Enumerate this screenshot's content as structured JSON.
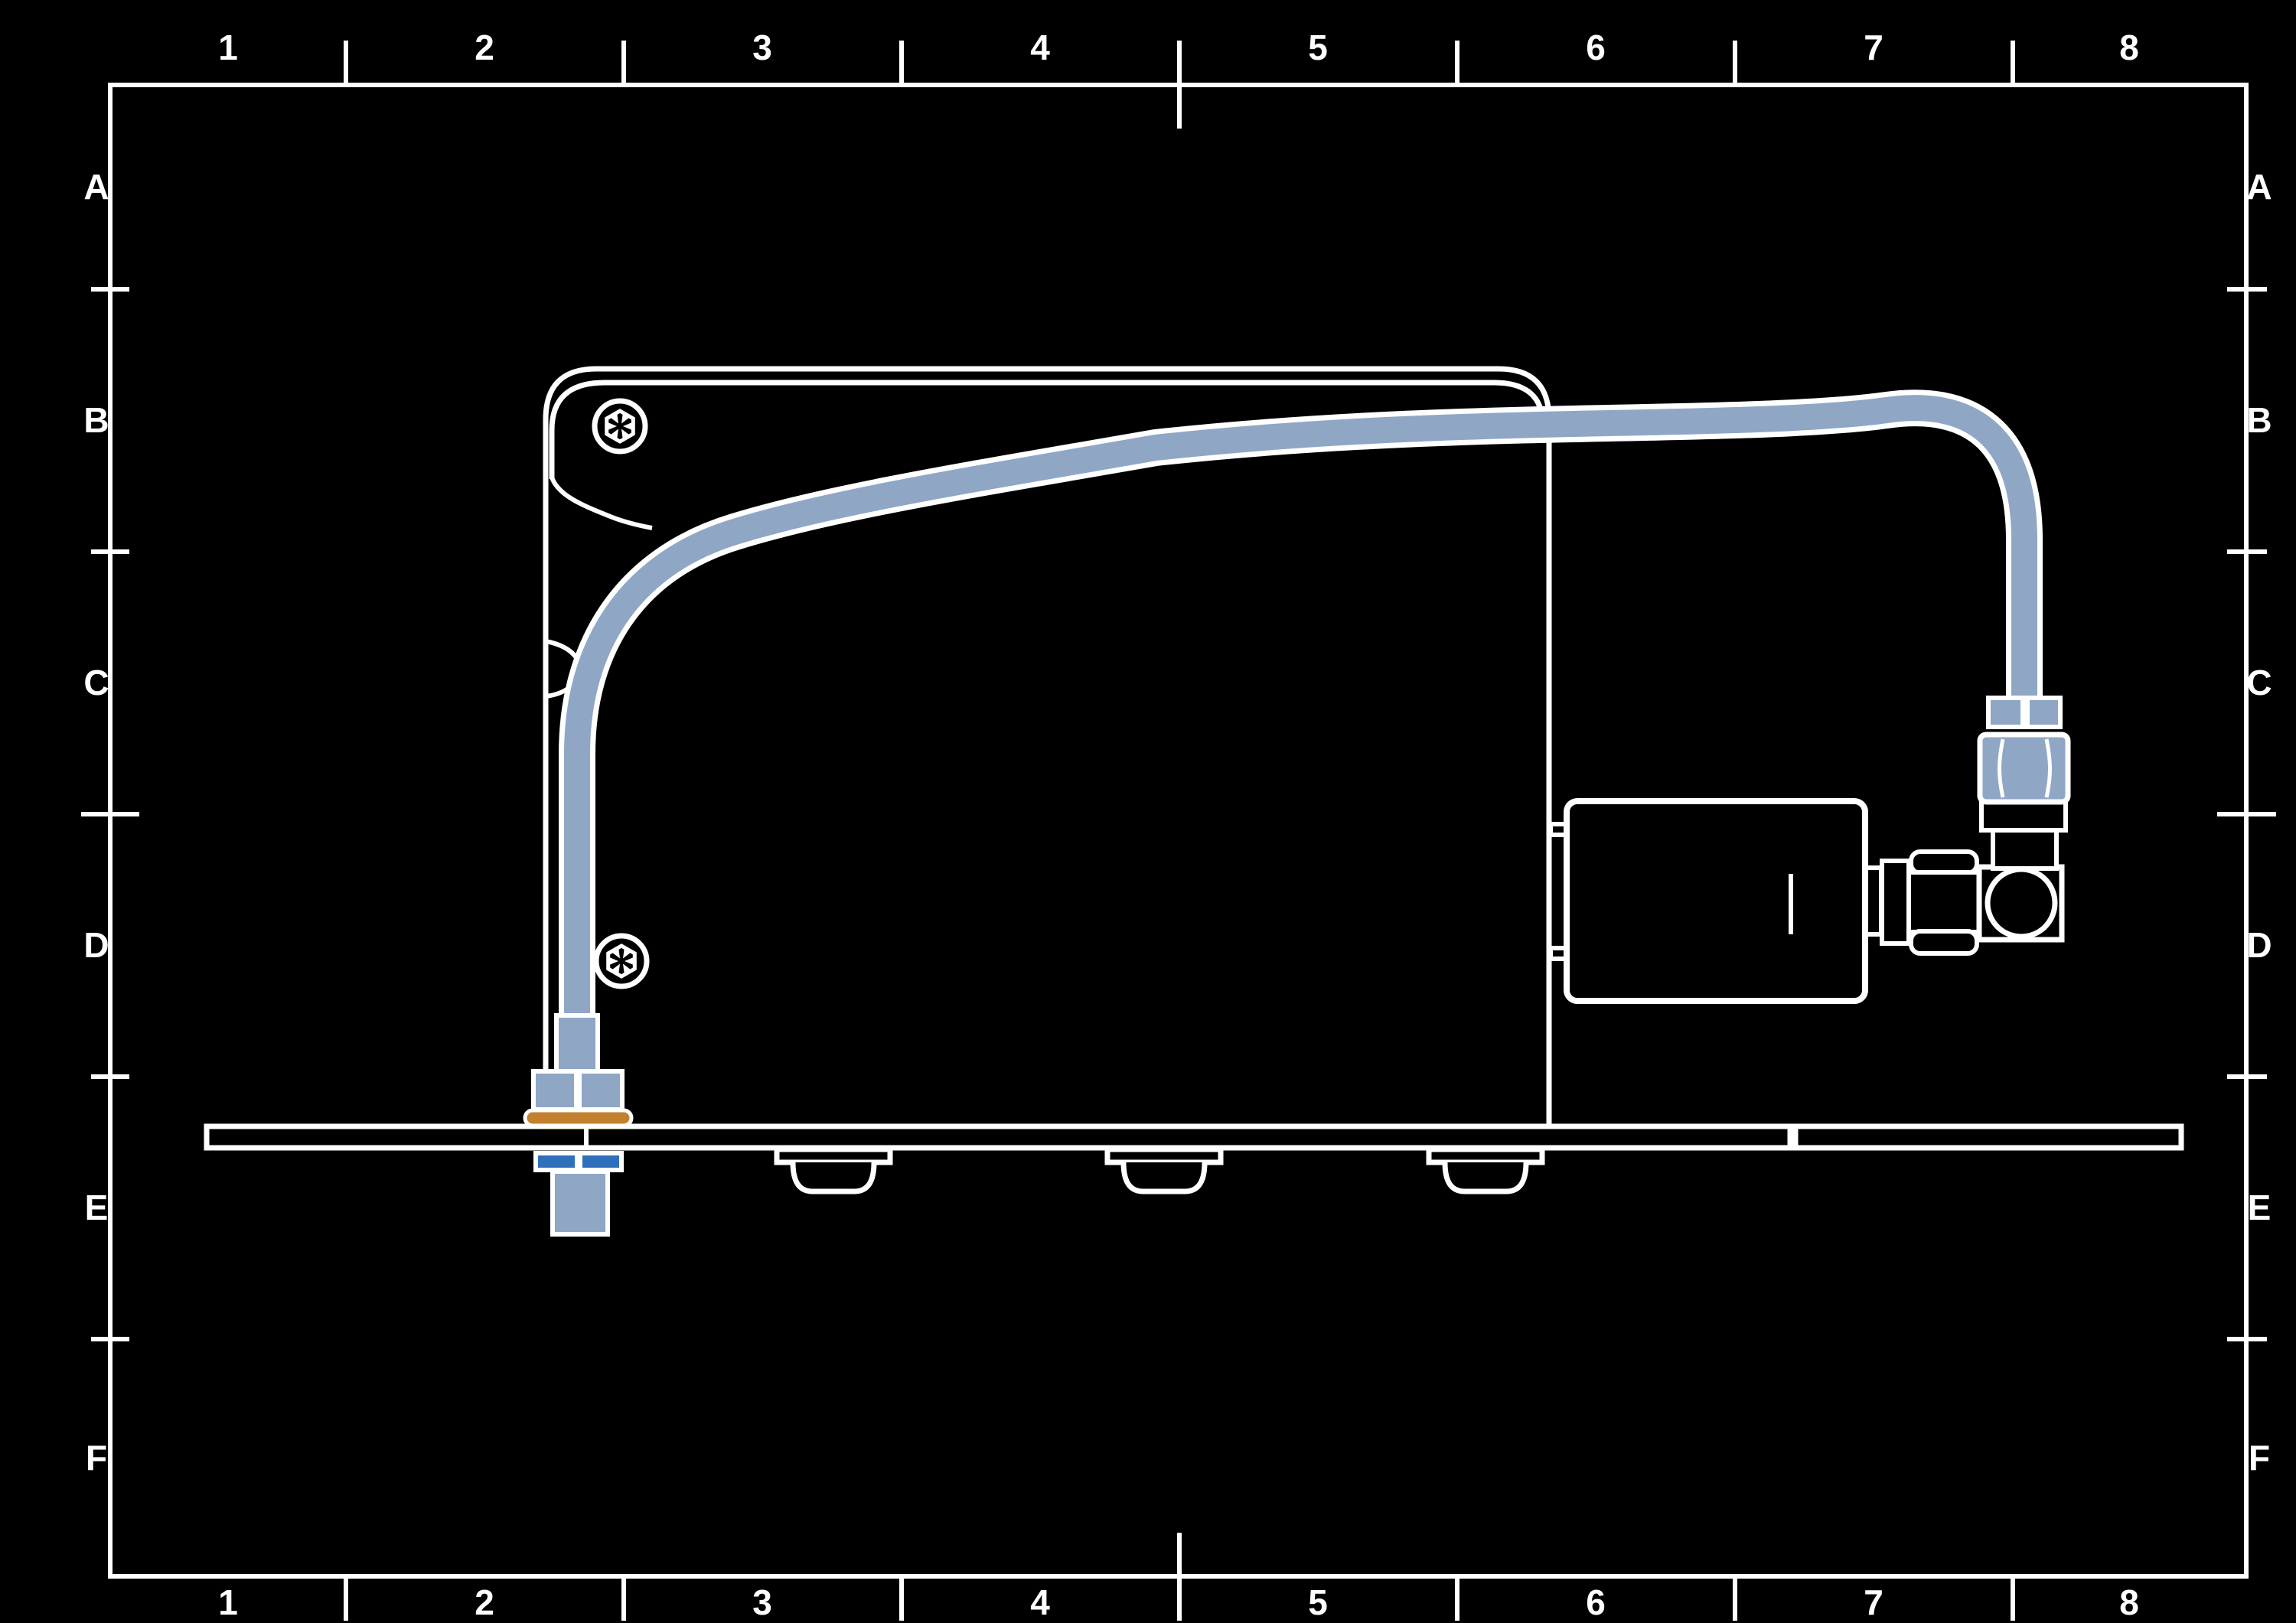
{
  "sheet": {
    "background_color": "#000000",
    "line_color": "#ffffff",
    "grid": {
      "columns": [
        "1",
        "2",
        "3",
        "4",
        "5",
        "6",
        "7",
        "8"
      ],
      "rows": [
        "A",
        "B",
        "C",
        "D",
        "E",
        "F"
      ]
    }
  },
  "drawing": {
    "colors": {
      "tube_blue": "#8FA7C5",
      "accent_blue": "#2F6FBC",
      "washer_orange": "#C3812F"
    }
  }
}
